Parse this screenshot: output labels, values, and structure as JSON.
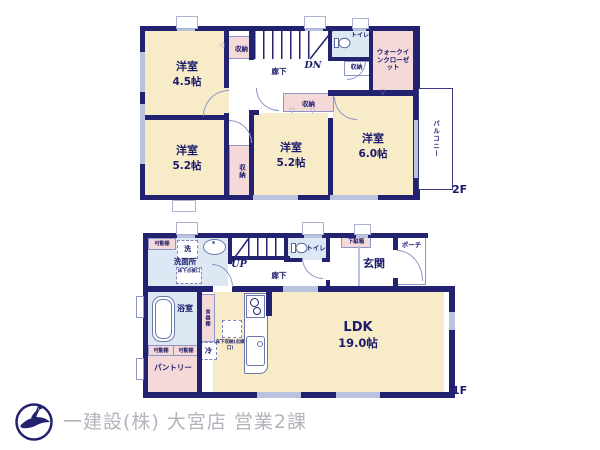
{
  "colors": {
    "wall": "#232270",
    "room": "#f8ecc8",
    "storage": "#f5d9d8",
    "water": "#dde8f4",
    "window": "#b9c3de",
    "text": "#1b1a6b",
    "footer_text": "#b3b3bc"
  },
  "floor2": {
    "floor_label": "2F",
    "room_45": {
      "name": "洋室",
      "size": "4.5帖"
    },
    "room_52_left": {
      "name": "洋室",
      "size": "5.2帖"
    },
    "room_52_mid": {
      "name": "洋室",
      "size": "5.2帖"
    },
    "room_60": {
      "name": "洋室",
      "size": "6.0帖"
    },
    "walk_in_closet": "ウォークインクローゼット",
    "toilet": "トイレ",
    "hallway": "廊下",
    "stairs_dn": "DN",
    "balcony": "バルコニー",
    "closet_stair": "収納",
    "closet_toilet": "収納",
    "closet_mid": "収納",
    "closet_vert": "収納"
  },
  "floor1": {
    "floor_label": "1F",
    "ldk": {
      "name": "LDK",
      "size": "19.0帖"
    },
    "washroom": "洗面所",
    "washer": "洗",
    "movable_shelf_top": "可動棚",
    "movable_shelf_left": "可動棚",
    "movable_shelf_right": "可動棚",
    "floor_hatch": "床下点検口",
    "stairs_up": "UP",
    "hallway": "廊下",
    "toilet": "トイレ",
    "shoe_box": "下駄箱",
    "entrance": "玄関",
    "porch": "ポーチ",
    "bathroom": "浴室",
    "pantry": "パントリー",
    "cupboard": "食器棚",
    "fridge": "冷",
    "floor_storage": "床下収納(点検口)"
  },
  "footer": {
    "company": "一建設(株) 大宮店 営業2課"
  }
}
